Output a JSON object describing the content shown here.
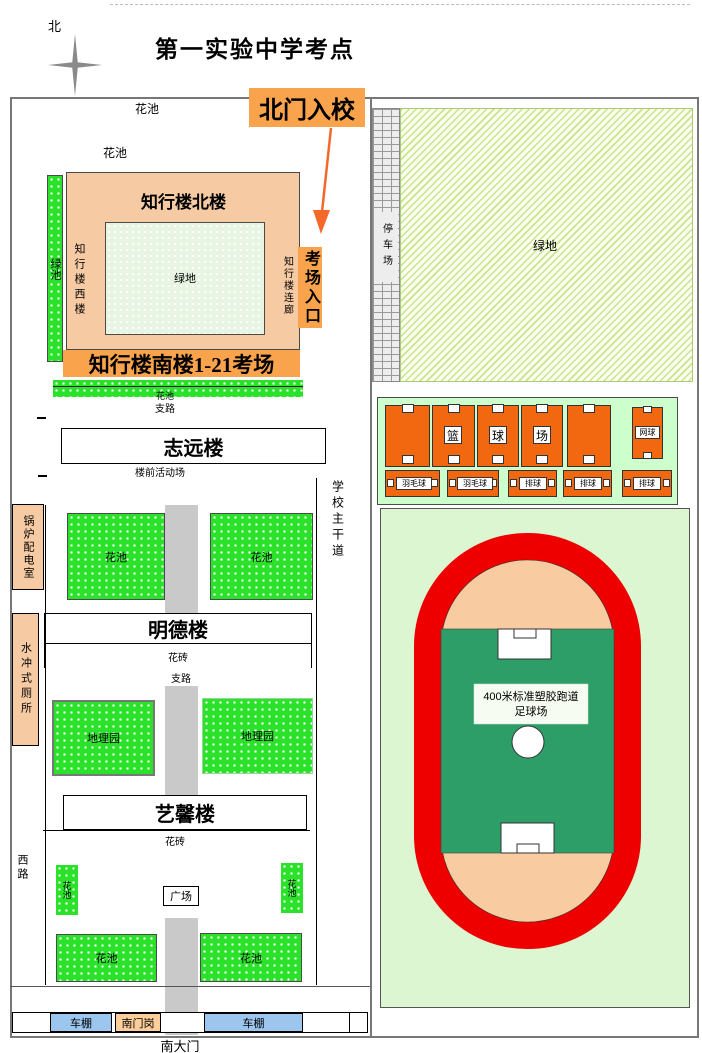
{
  "title": "第一实验中学考点",
  "compass": {
    "north_label": "北"
  },
  "north_gate": {
    "label": "北门入校"
  },
  "exam_entrance": {
    "label": "考场入口"
  },
  "zhixing": {
    "north": "知行楼北楼",
    "west": "知行楼西楼",
    "corridor": "知行楼连廊",
    "south_banner": "知行楼南楼1-21考场",
    "green": "绿地",
    "left_strip": "绿池"
  },
  "buildings": {
    "zhiyuan": "志远楼",
    "zhiyuan_sub": "楼前活动场",
    "mingde": "明德楼",
    "yixin": "艺馨楼"
  },
  "labels": {
    "flower_bed": "花池",
    "branch_road": "支路",
    "flower_brick": "花砖",
    "geo_garden": "地理园",
    "west_road": "西路",
    "main_road": "学校主干道",
    "parking": "停车场",
    "green_space": "绿地",
    "plaza": "广场",
    "bike_shed": "车棚",
    "south_gate_post": "南门岗",
    "south_gate": "南大门",
    "boiler_room": "锅炉配电室",
    "toilet": "水冲式厕所"
  },
  "courts": {
    "basketball_chars": [
      "篮",
      "球",
      "场"
    ],
    "tennis": "网球",
    "small": [
      "羽毛球",
      "羽毛球",
      "排球",
      "排球",
      "排球"
    ]
  },
  "stadium": {
    "line1": "400米标准塑胶跑道",
    "line2": "足球场"
  },
  "colors": {
    "accent_orange": "#F9A44D",
    "court_orange": "#F26811",
    "track_red": "#EE0000",
    "field_green": "#2E9E68",
    "infield_peach": "#F8CBA0",
    "building_peach": "#F6CBA3",
    "shed_blue": "#9CC6EE",
    "bright_green": "#2BE22B"
  }
}
